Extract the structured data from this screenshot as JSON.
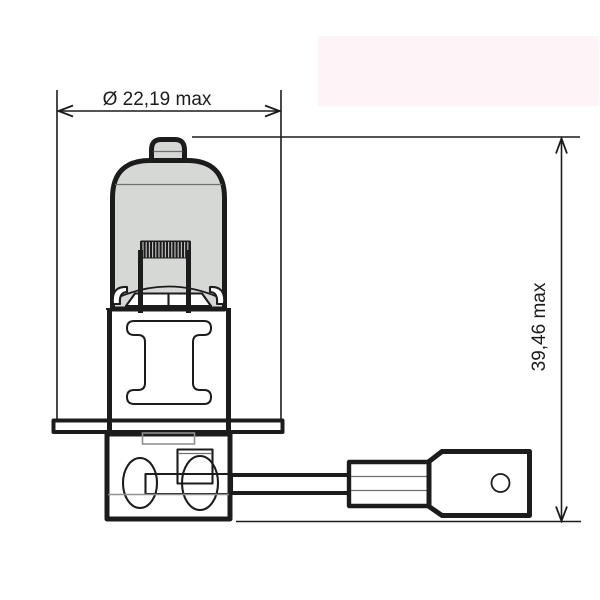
{
  "diagram": {
    "width_dimension": "Ø 22,19 max",
    "height_dimension": "39,46 max"
  },
  "colors": {
    "line": "#1c1c1c",
    "glass_fill": "#d6d8d6",
    "highlight_box": "#fcf4f6",
    "background": "#ffffff"
  }
}
